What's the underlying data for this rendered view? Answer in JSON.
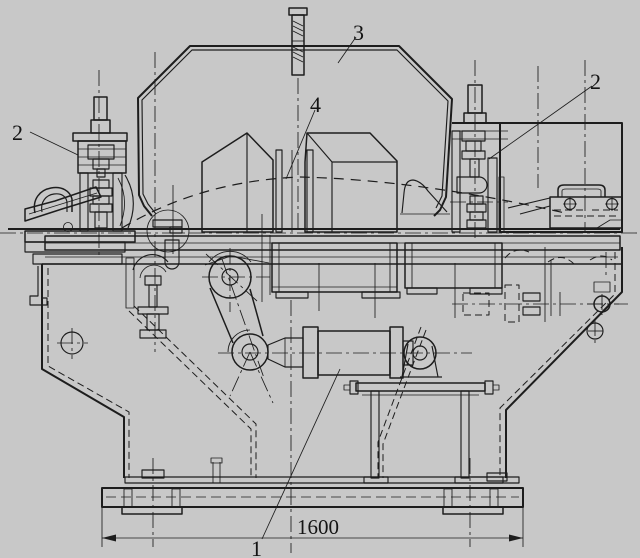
{
  "colors": {
    "background": "#c8c8c8",
    "line": "#1d1d1d"
  },
  "callouts": {
    "c1": "1",
    "c2_left": "2",
    "c2_right": "2",
    "c3": "3",
    "c4": "4"
  },
  "dimension": {
    "base_width": "1600"
  }
}
